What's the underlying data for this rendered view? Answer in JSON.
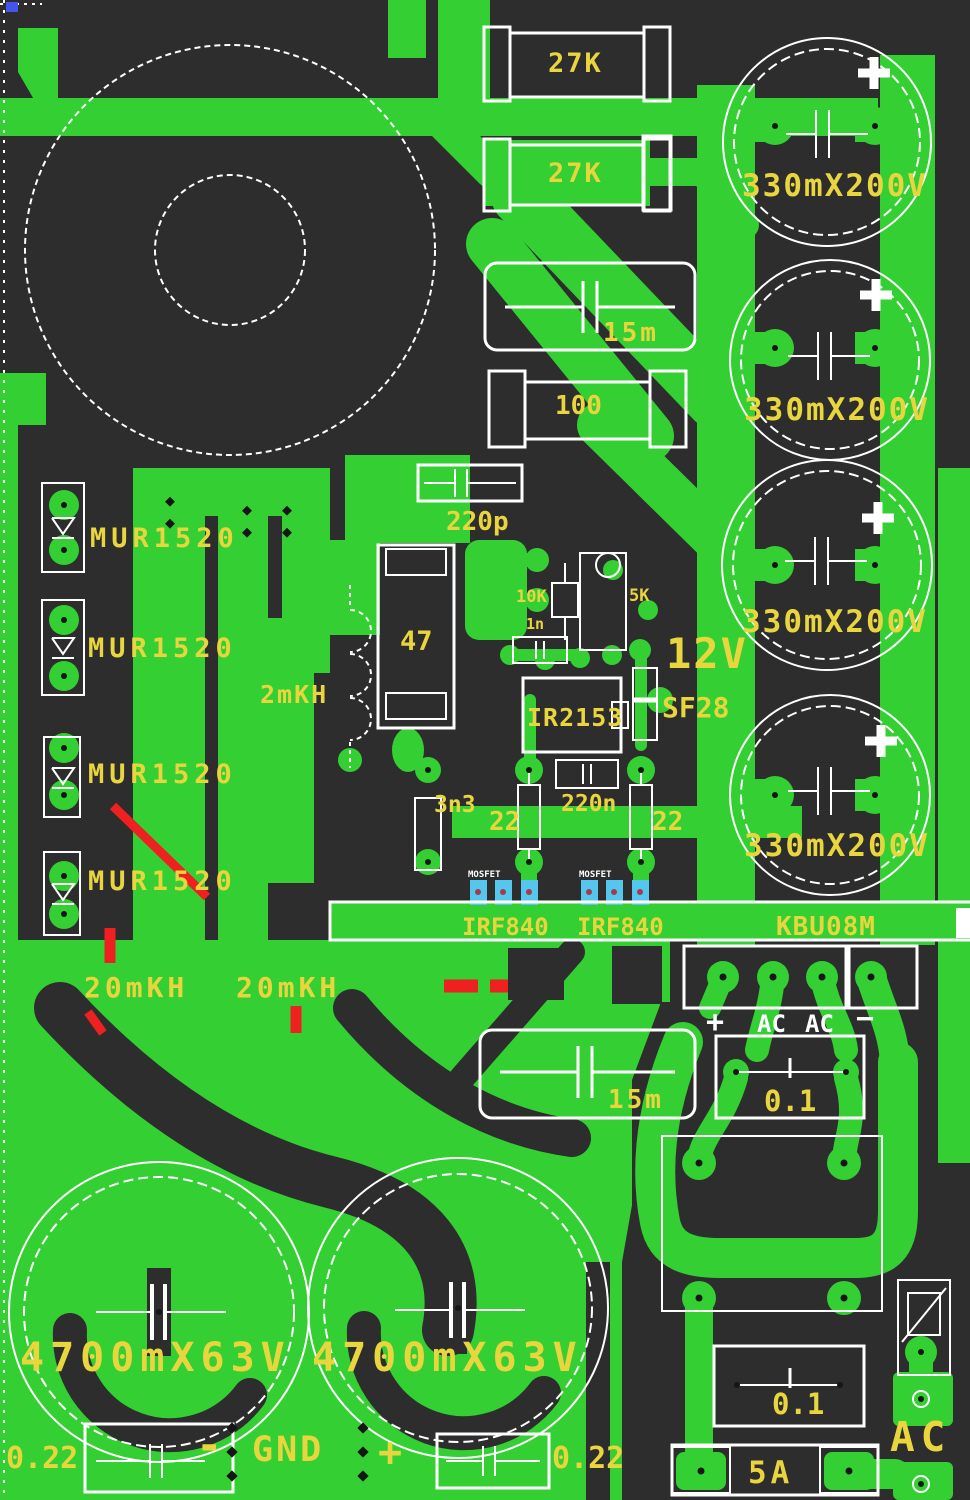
{
  "meta": {
    "type": "pcb-copper-layout",
    "width": 970,
    "height": 1500
  },
  "colors": {
    "board": "#2d2d2d",
    "copper": "#33cf33",
    "silkscreen": "#ffffff",
    "label_yellow": "#e9d63e",
    "jumper_red": "#ee2020",
    "pad_blue": "#55c6ee",
    "pad_dot_red": "#a8394a",
    "corner_blue": "#4455ee"
  },
  "labels": {
    "r27k_1": "27K",
    "r27k_2": "27K",
    "cap330_1": "330mX200V",
    "cap330_2": "330mX200V",
    "cap330_3": "330mX200V",
    "cap330_4": "330mX200V",
    "c15m_1": "15m",
    "c15m_2": "15m",
    "r100": "100",
    "c220p": "220p",
    "mur1520_1": "MUR1520",
    "mur1520_2": "MUR1520",
    "mur1520_3": "MUR1520",
    "mur1520_4": "MUR1520",
    "l2mkh": "2mKH",
    "r47": "47",
    "r10k": "10K",
    "r5k": "5K",
    "c1n": "1n",
    "v12": "12V",
    "sf28": "SF28",
    "ir2153": "IR2153",
    "c3n3": "3n3",
    "r22_1": "22",
    "c220n": "220n",
    "r22_2": "22",
    "mosfet_1": "MOSFET",
    "mosfet_2": "MOSFET",
    "irf840_1": "IRF840",
    "irf840_2": "IRF840",
    "kbu08m": "KBU08M",
    "l20mkh_1": "20mKH",
    "l20mkh_2": "20mKH",
    "bridge_plus": "+",
    "bridge_ac1": "AC",
    "bridge_ac2": "AC",
    "bridge_minus": "−",
    "c01_1": "0.1",
    "c01_2": "0.1",
    "cap4700_1": "4700mX63V",
    "cap4700_2": "4700mX63V",
    "c022_1": "0.22",
    "c022_2": "0.22",
    "out_minus": "-",
    "out_gnd": "GND",
    "out_plus": "+",
    "fuse": "5A",
    "ac_input": "AC"
  }
}
